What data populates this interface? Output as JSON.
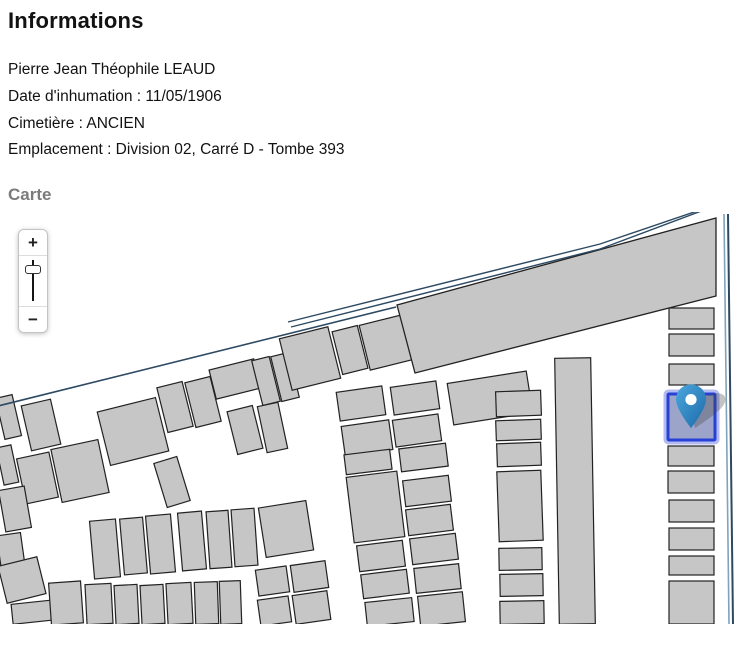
{
  "page": {
    "title": "Informations",
    "map_section_label": "Carte"
  },
  "info": {
    "lines": [
      "Pierre Jean Théophile LEAUD",
      "Date d'inhumation : 11/05/1906",
      "Cimetière : ANCIEN",
      "Emplacement : Division 02, Carré D - Tombe 393"
    ]
  },
  "map": {
    "zoom_control": {
      "zoom_in_label": "+",
      "zoom_out_label": "−"
    },
    "colors": {
      "tomb_fill": "#c6c6c6",
      "tomb_stroke": "#222222",
      "boundary_dark": "#2e4a63",
      "boundary_light": "#7fa3bd",
      "selected_fill": "#9da4c9",
      "selected_border": "#2740d6",
      "selected_glow": "#8b96ea",
      "marker_light": "#4da7dd",
      "marker_dark": "#1b6aa8",
      "marker_shadow": "#444444"
    },
    "building": "397,93 716,6 716,84 415,161",
    "boundaries": [
      {
        "points": "-6,195 396,95",
        "color_key": "boundary_dark",
        "width": 1.6
      },
      {
        "points": "288,110 600,32 700,-2",
        "color_key": "boundary_dark",
        "width": 1.4
      },
      {
        "points": "291,115 600,37 704,-2",
        "color_key": "boundary_dark",
        "width": 1.4
      },
      {
        "points": "724,2 729,412",
        "color_key": "boundary_light",
        "width": 1.6
      },
      {
        "points": "728,2 733,412",
        "color_key": "boundary_dark",
        "width": 2
      }
    ],
    "tombs": [
      [
        103,
        192,
        60,
        55,
        -14
      ],
      [
        162,
        172,
        26,
        46,
        -14
      ],
      [
        190,
        167,
        26,
        46,
        -14
      ],
      [
        212,
        152,
        46,
        30,
        -14
      ],
      [
        232,
        196,
        26,
        44,
        -14
      ],
      [
        257,
        146,
        18,
        46,
        -14
      ],
      [
        276,
        142,
        18,
        46,
        -14
      ],
      [
        285,
        120,
        50,
        53,
        -14
      ],
      [
        337,
        116,
        26,
        44,
        -14
      ],
      [
        364,
        107,
        48,
        46,
        -14
      ],
      [
        0,
        184,
        17,
        42,
        -13
      ],
      [
        26,
        190,
        30,
        46,
        -13
      ],
      [
        0,
        234,
        15,
        38,
        -12
      ],
      [
        21,
        243,
        33,
        46,
        -12
      ],
      [
        56,
        232,
        48,
        54,
        -12
      ],
      [
        2,
        276,
        26,
        42,
        -10
      ],
      [
        0,
        322,
        24,
        50,
        -8
      ],
      [
        160,
        247,
        24,
        46,
        -17
      ],
      [
        262,
        192,
        21,
        47,
        -12
      ],
      [
        92,
        308,
        26,
        58,
        -5
      ],
      [
        122,
        306,
        23,
        56,
        -5
      ],
      [
        148,
        303,
        25,
        58,
        -5
      ],
      [
        180,
        300,
        24,
        58,
        -5
      ],
      [
        208,
        299,
        22,
        57,
        -4
      ],
      [
        233,
        297,
        23,
        57,
        -4
      ],
      [
        262,
        292,
        48,
        50,
        -9
      ],
      [
        2,
        349,
        40,
        38,
        -14
      ],
      [
        12,
        390,
        44,
        20,
        -6
      ],
      [
        50,
        370,
        32,
        42,
        -4
      ],
      [
        86,
        372,
        26,
        40,
        -3
      ],
      [
        115,
        373,
        23,
        39,
        -3
      ],
      [
        141,
        373,
        23,
        39,
        -3
      ],
      [
        167,
        371,
        25,
        41,
        -3
      ],
      [
        195,
        370,
        23,
        42,
        -2
      ],
      [
        220,
        369,
        21,
        43,
        -2
      ],
      [
        257,
        356,
        31,
        26,
        -8
      ],
      [
        292,
        351,
        35,
        27,
        -8
      ],
      [
        259,
        386,
        31,
        26,
        -8
      ],
      [
        294,
        381,
        35,
        29,
        -8
      ],
      [
        338,
        177,
        46,
        29,
        -8
      ],
      [
        392,
        172,
        46,
        28,
        -8
      ],
      [
        343,
        211,
        48,
        30,
        -8
      ],
      [
        394,
        205,
        46,
        27,
        -8
      ],
      [
        450,
        165,
        80,
        42,
        -9
      ],
      [
        345,
        240,
        46,
        20,
        -7
      ],
      [
        350,
        262,
        51,
        66,
        -7
      ],
      [
        358,
        331,
        46,
        26,
        -7
      ],
      [
        362,
        360,
        46,
        24,
        -7
      ],
      [
        366,
        388,
        47,
        24,
        -6
      ],
      [
        400,
        234,
        47,
        23,
        -7
      ],
      [
        404,
        266,
        46,
        26,
        -7
      ],
      [
        407,
        295,
        45,
        26,
        -7
      ],
      [
        411,
        324,
        46,
        26,
        -7
      ],
      [
        415,
        354,
        45,
        25,
        -6
      ],
      [
        419,
        382,
        45,
        30,
        -6
      ],
      [
        496,
        179,
        45,
        25,
        -2
      ],
      [
        496,
        208,
        45,
        20,
        -2
      ],
      [
        497,
        231,
        44,
        23,
        -2
      ],
      [
        498,
        259,
        44,
        70,
        -2
      ],
      [
        499,
        336,
        43,
        22,
        -1
      ],
      [
        500,
        362,
        43,
        22,
        -1
      ],
      [
        500,
        389,
        44,
        23,
        -1
      ],
      [
        557,
        146,
        36,
        266,
        -1
      ],
      [
        669,
        96,
        45,
        21,
        0
      ],
      [
        669,
        122,
        45,
        22,
        0
      ],
      [
        669,
        152,
        45,
        21,
        0
      ],
      [
        668,
        234,
        46,
        20,
        0
      ],
      [
        668,
        259,
        46,
        22,
        0
      ],
      [
        669,
        288,
        45,
        22,
        0
      ],
      [
        669,
        316,
        45,
        22,
        0
      ],
      [
        669,
        344,
        45,
        19,
        0
      ],
      [
        669,
        369,
        45,
        43,
        0
      ]
    ],
    "selected_tomb": {
      "x": 668,
      "y": 182,
      "w": 47,
      "h": 46
    },
    "marker": {
      "x": 691,
      "y": 216
    }
  }
}
